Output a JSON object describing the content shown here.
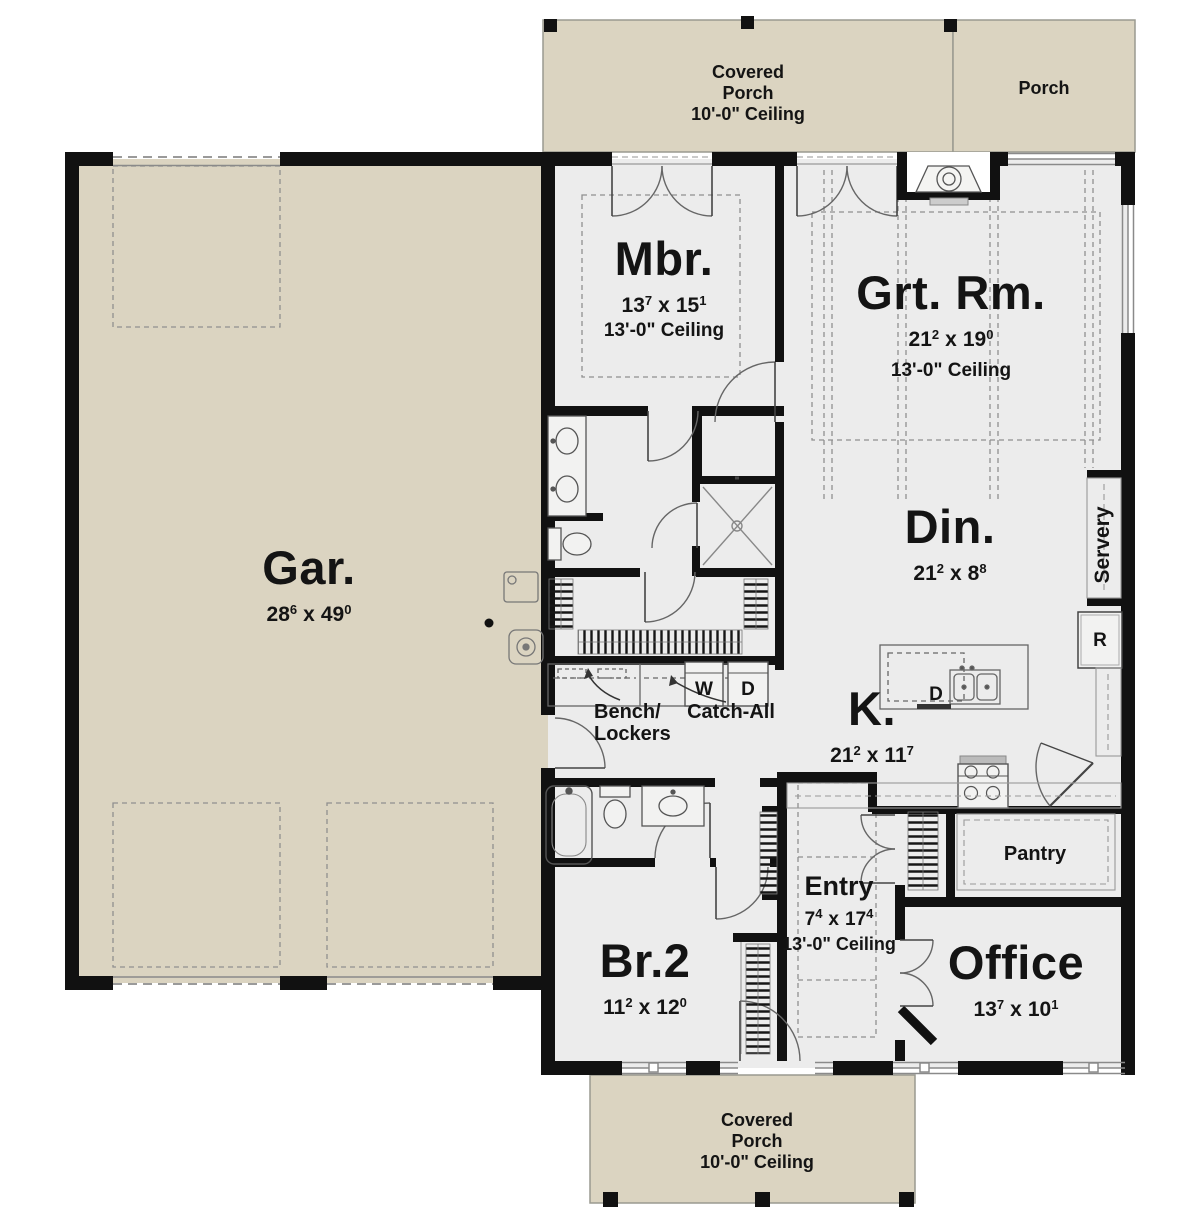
{
  "sep": "x",
  "porch_top": {
    "l1": "Covered",
    "l2": "Porch",
    "ceiling": "10'-0\" Ceiling"
  },
  "porch_right": {
    "name": "Porch"
  },
  "porch_bottom": {
    "l1": "Covered",
    "l2": "Porch",
    "ceiling": "10'-0\" Ceiling"
  },
  "rooms": {
    "mbr": {
      "name": "Mbr.",
      "w": "13",
      "wi": "7",
      "l": "15",
      "li": "1",
      "ceiling": "13'-0\" Ceiling"
    },
    "grt_rm": {
      "name": "Grt. Rm.",
      "w": "21",
      "wi": "2",
      "l": "19",
      "li": "0",
      "ceiling": "13'-0\" Ceiling"
    },
    "gar": {
      "name": "Gar.",
      "w": "28",
      "wi": "6",
      "l": "49",
      "li": "0"
    },
    "din": {
      "name": "Din.",
      "w": "21",
      "wi": "2",
      "l": "8",
      "li": "8"
    },
    "kitchen": {
      "name": "K.",
      "w": "21",
      "wi": "2",
      "l": "11",
      "li": "7"
    },
    "entry": {
      "name": "Entry",
      "w": "7",
      "wi": "4",
      "l": "17",
      "li": "4",
      "ceiling": "13'-0\" Ceiling"
    },
    "br2": {
      "name": "Br.2",
      "w": "11",
      "wi": "2",
      "l": "12",
      "li": "0"
    },
    "office": {
      "name": "Office",
      "w": "13",
      "wi": "7",
      "l": "10",
      "li": "1"
    }
  },
  "labels": {
    "servery": "Servery",
    "pantry": "Pantry",
    "bench_l1": "Bench/",
    "bench_l2": "Lockers",
    "catch_all": "Catch-All",
    "washer": "W",
    "dryer": "D",
    "dishwasher": "D",
    "fridge": "R"
  },
  "colors": {
    "wall": "#111111",
    "porch_fill": "#dbd4c1",
    "floor_fill": "#ececec",
    "background": "#ffffff"
  }
}
